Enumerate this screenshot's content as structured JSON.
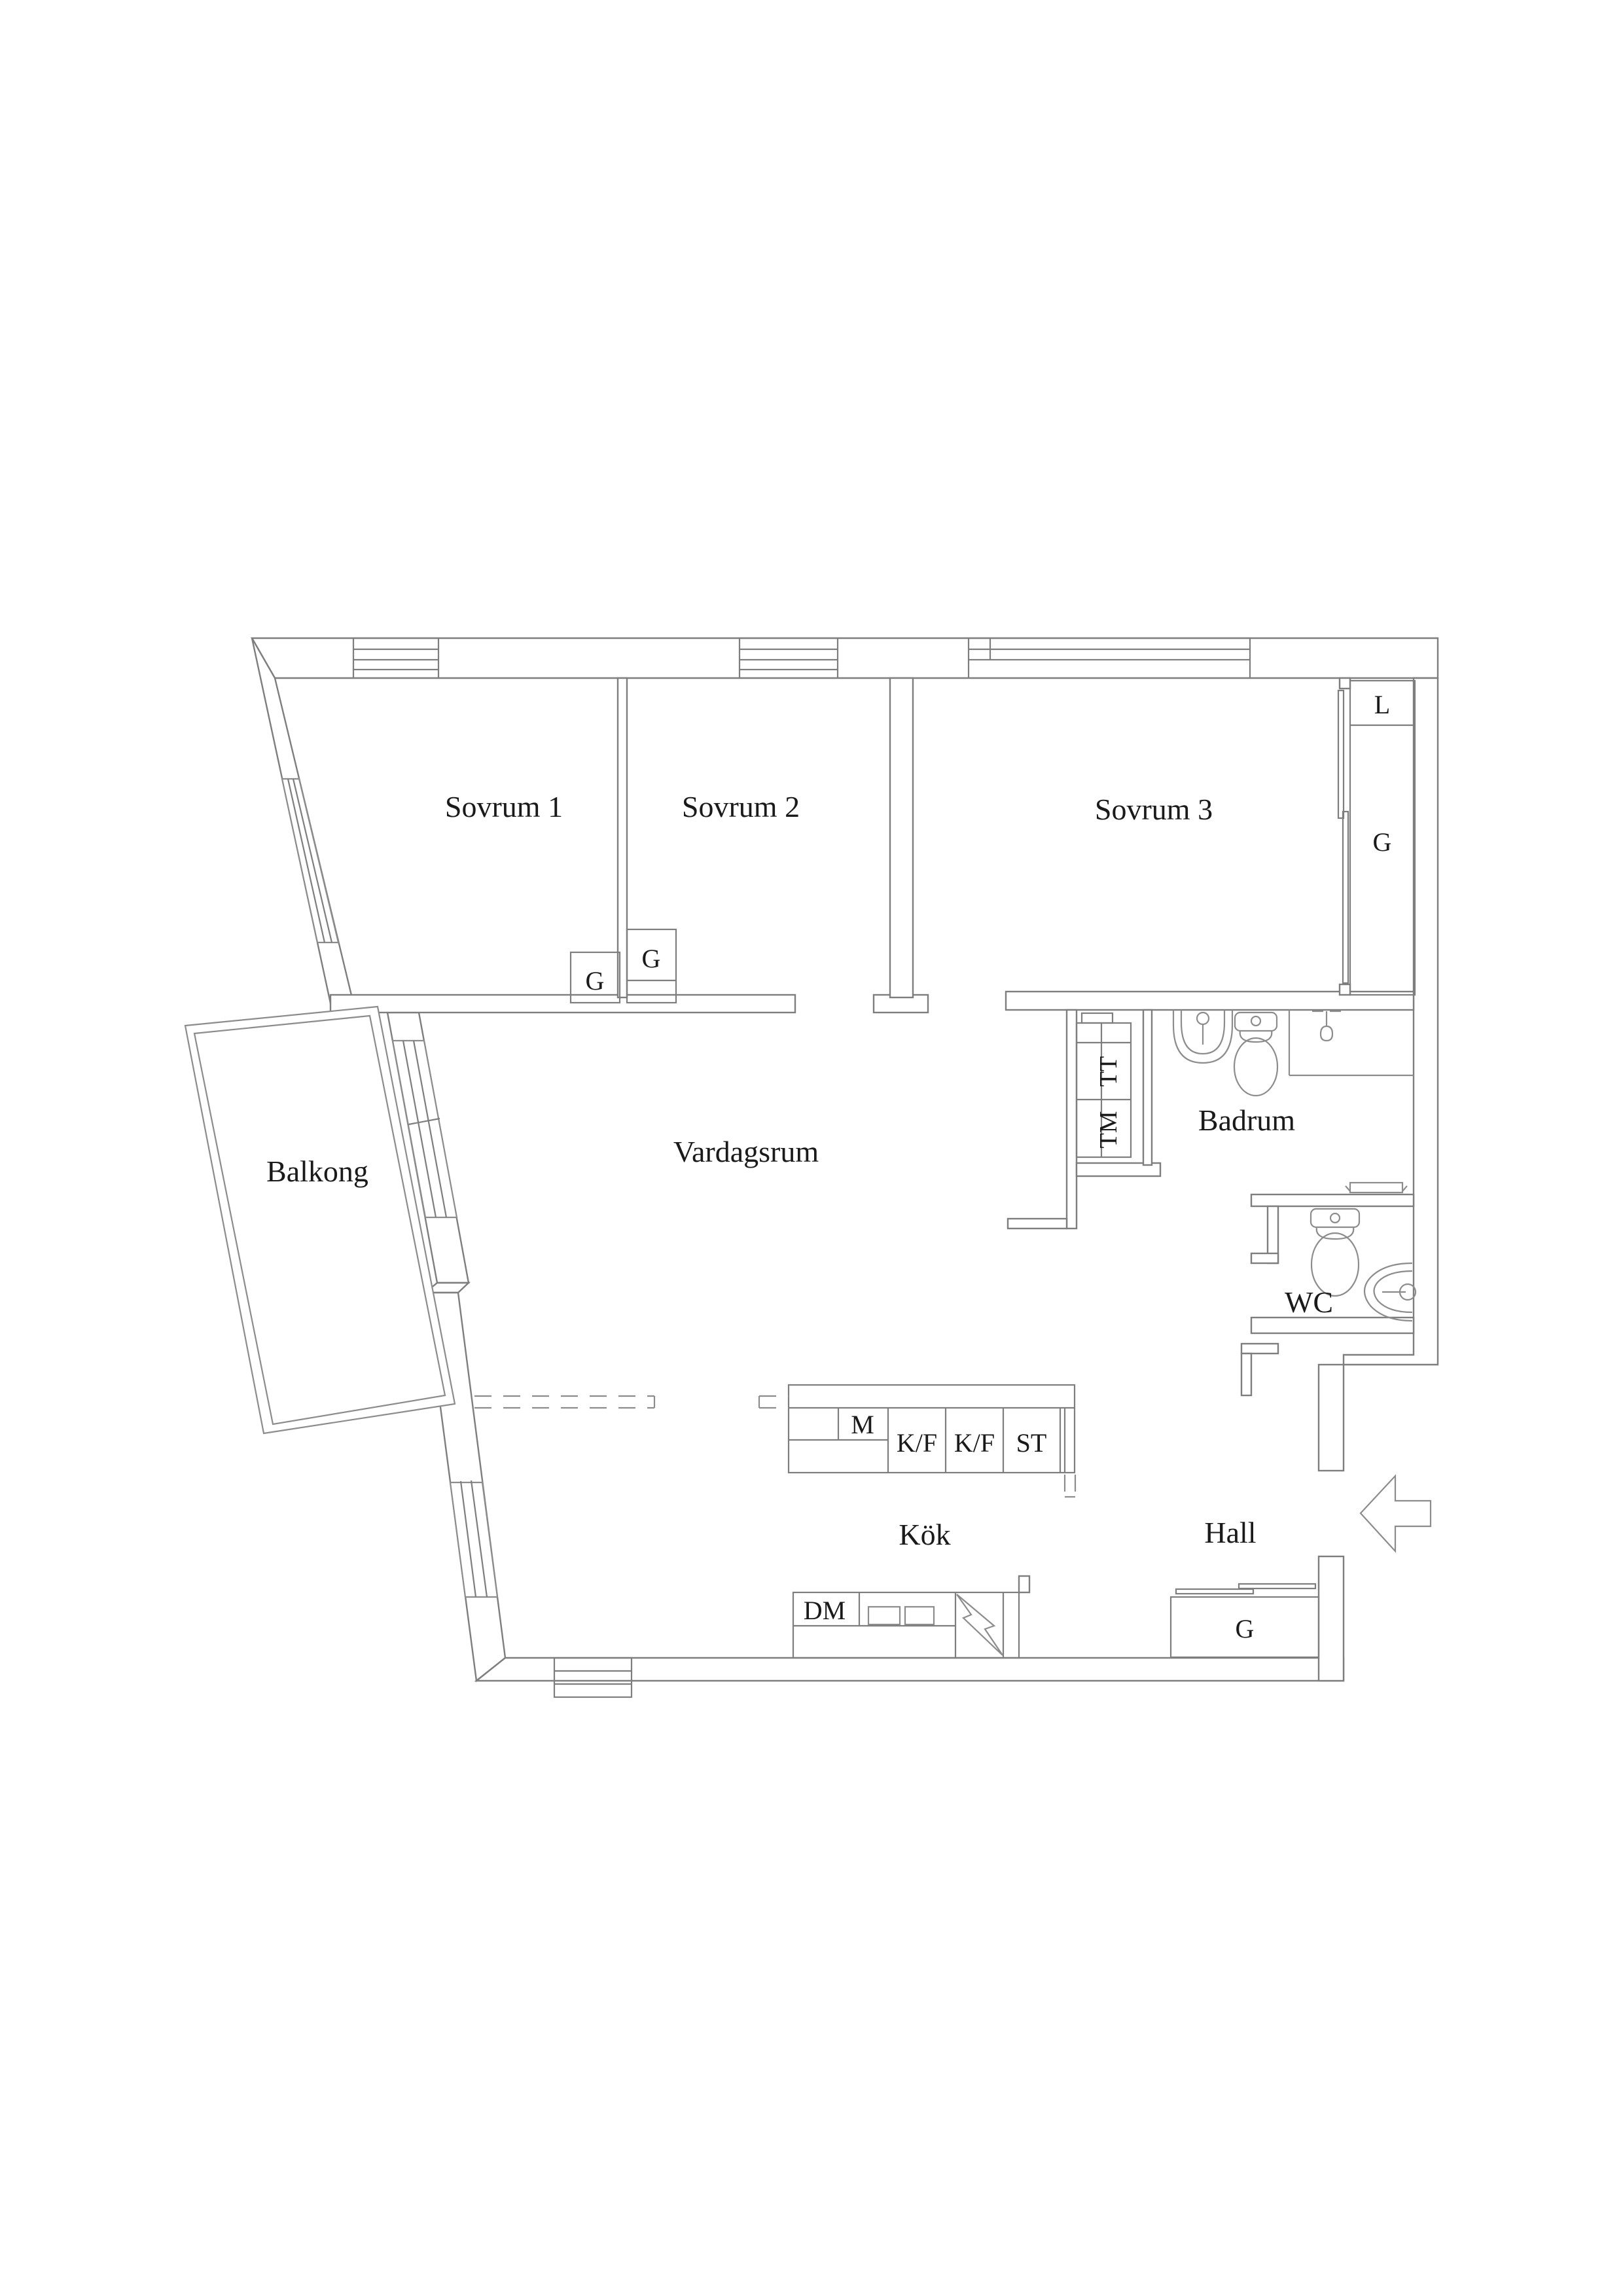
{
  "colors": {
    "background": "#ffffff",
    "wall": "#7e7e7e",
    "fixture": "#8c8c8c",
    "text": "#1a1a1a"
  },
  "labels": {
    "sovrum1": "Sovrum 1",
    "sovrum2": "Sovrum 2",
    "sovrum3": "Sovrum 3",
    "vardagsrum": "Vardagsrum",
    "balkong": "Balkong",
    "badrum": "Badrum",
    "wc": "WC",
    "kok": "Kök",
    "hall": "Hall"
  },
  "fixture_labels": {
    "closet_l": "L",
    "closet_g": "G",
    "bedroom1_g": "G",
    "bedroom2_g": "G",
    "hall_g": "G",
    "dryer": "TT",
    "washer": "TM",
    "microwave": "M",
    "fridge_freezer_1": "K/F",
    "fridge_freezer_2": "K/F",
    "tall_cabinet": "ST",
    "dishwasher": "DM"
  },
  "icons": {
    "entrance": "entrance-arrow-icon",
    "badrum_sink": "sink-icon",
    "badrum_toilet": "toilet-icon",
    "shower": "shower-head-icon",
    "radiator": "radiator-icon",
    "wc_toilet": "toilet-icon",
    "wc_sink": "round-sink-icon",
    "kitchen_sink": "double-sink-icon",
    "stove_power": "lightning-icon",
    "sliding_door": "sliding-door-icon",
    "windows": "window-icon"
  }
}
